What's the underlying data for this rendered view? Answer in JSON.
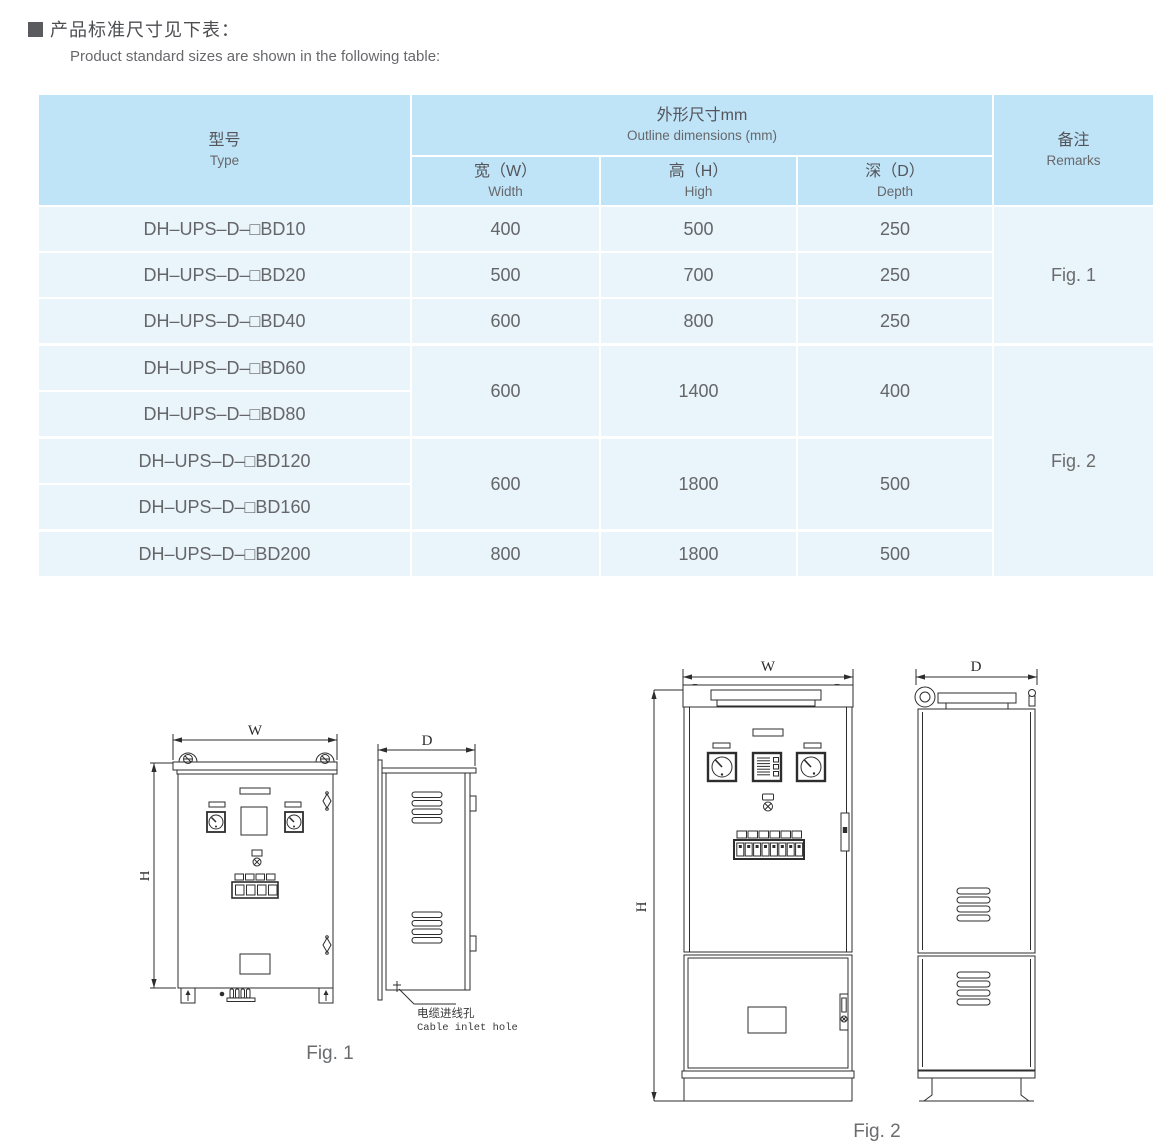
{
  "page": {
    "heading_zh": "产品标准尺寸见下表：",
    "heading_en": "Product standard sizes are shown in the following table:"
  },
  "table": {
    "header": {
      "type_zh": "型号",
      "type_en": "Type",
      "outline_zh": "外形尺寸mm",
      "outline_en": "Outline dimensions (mm)",
      "width_zh": "宽（W）",
      "width_en": "Width",
      "high_zh": "高（H）",
      "high_en": "High",
      "depth_zh": "深（D）",
      "depth_en": "Depth",
      "remarks_zh": "备注",
      "remarks_en": "Remarks"
    },
    "rows": [
      {
        "model": "DH–UPS–D–□BD10",
        "w": "400",
        "h": "500",
        "d": "250"
      },
      {
        "model": "DH–UPS–D–□BD20",
        "w": "500",
        "h": "700",
        "d": "250"
      },
      {
        "model": "DH–UPS–D–□BD40",
        "w": "600",
        "h": "800",
        "d": "250"
      },
      {
        "model": "DH–UPS–D–□BD60",
        "w": "600",
        "h": "1400",
        "d": "400"
      },
      {
        "model": "DH–UPS–D–□BD80"
      },
      {
        "model": "DH–UPS–D–□BD120",
        "w": "600",
        "h": "1800",
        "d": "500"
      },
      {
        "model": "DH–UPS–D–□BD160"
      },
      {
        "model": "DH–UPS–D–□BD200",
        "w": "800",
        "h": "1800",
        "d": "500"
      }
    ],
    "remarks": {
      "fig1": "Fig. 1",
      "fig2": "Fig. 2"
    }
  },
  "figures": {
    "fig1": {
      "caption": "Fig. 1",
      "dim_w": "W",
      "dim_h": "H",
      "dim_d": "D",
      "cable_label_zh": "电缆进线孔",
      "cable_label_en": "Cable inlet hole"
    },
    "fig2": {
      "caption": "Fig. 2",
      "dim_w": "W",
      "dim_h": "H",
      "dim_d": "D"
    }
  },
  "colors": {
    "header_bg": "#bfe3f7",
    "row_bg": "#e9f4fb",
    "text_gray": "#58595b",
    "line": "#2d2d2d"
  }
}
